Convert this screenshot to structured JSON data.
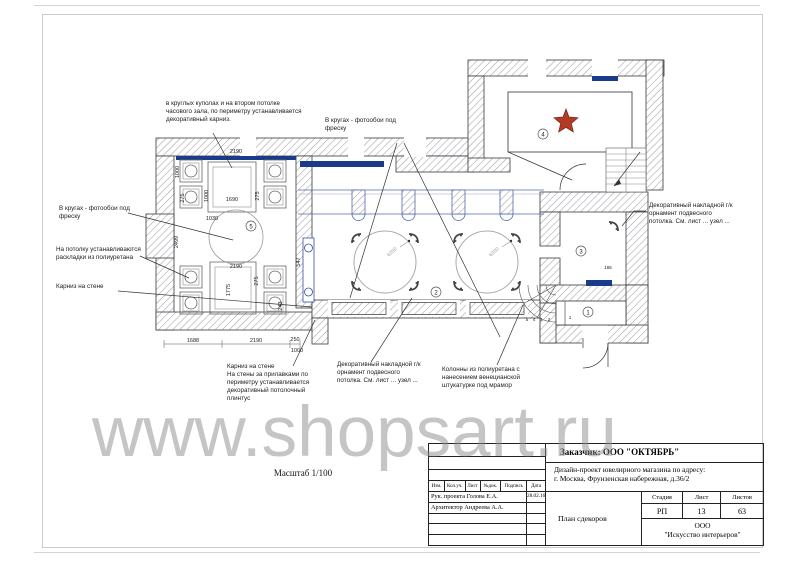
{
  "page": {
    "watermark": "www.shopsart.ru",
    "scale": "Масштаб 1/100"
  },
  "annotations": {
    "dome_note": "в круглых куполах и на втором потолке\nчасового зала, по периметру устанавливается\nдекоративный карниз.",
    "circles_photo_top": "В кругах - фотообои под\nфреску",
    "circles_photo_left": "В кругах - фотообои под\nфреску",
    "moldings": "На потолку устанавливаются\nраскладки из полиуретана",
    "cornice_left": "Карниз на стене",
    "cornice_bottom": "Карниз на стене\nНа стены за прилавками по\nпериметру устанавливается\nдекоративный потолочный\nплинтус",
    "ornament_bottom": "Декоративный накладной г/к\nорнамент подвесного\nпотолка. См. лист ... узел ...",
    "columns_note": "Колонны из полиуретана с\nнанесением венецианской\nштукатурке под мрамор",
    "ornament_right": "Декоративный накладной г/к\nорнамент подвесного\nпотолка. См. лист ... узел ..."
  },
  "plan": {
    "rooms": {
      "r1": "1",
      "r2": "2",
      "r3": "3",
      "r4": "4",
      "r5": "5"
    },
    "circle_diameter_a": "6200",
    "circle_diameter_b": "6200",
    "stairs": [
      "5",
      "4",
      "3",
      "2",
      "1"
    ],
    "colors": {
      "accent_blue": "#1a3a8c",
      "band_blue": "#3a4fa0",
      "star_red": "#b43a25"
    },
    "dims": {
      "top2190": "2190",
      "v1000a": "1000",
      "v275a": "275",
      "v1000b": "1000",
      "d1690": "1690",
      "v275b": "275",
      "d1030": "1030",
      "v2499": "2499",
      "mid2190": "2190",
      "v275c": "275",
      "v1775": "1775",
      "v243": "243",
      "b1688": "1688",
      "b2190": "2190",
      "b250": "250",
      "b1000": "1000",
      "v547": "547",
      "d165": "165"
    }
  },
  "title_block": {
    "customer": "Заказчик:  ООО \"ОКТЯБРЬ\"",
    "project": "Дизайн-проект ювелирного магазина по адресу:\nг. Москва, Фрунзенская набережная, д.36/2",
    "sheet_title": "План сдекоров",
    "stage_label": "Стадия",
    "sheet_label": "Лист",
    "sheets_label": "Листов",
    "stage": "РП",
    "sheet": "13",
    "sheets": "63",
    "company": "ООО\n\"Искусство интерьеров\"",
    "cols": {
      "izm": "Изм.",
      "kol": "Кол.уч.",
      "list": "Лист",
      "ndoc": "№док.",
      "podpis": "Подпись",
      "data": "Дата"
    },
    "rows": [
      {
        "role": "Рук. проекта  Голова Е.А.",
        "date": "28.02.16"
      },
      {
        "role": "Архитектор   Андреева А.А.",
        "date": ""
      }
    ]
  }
}
